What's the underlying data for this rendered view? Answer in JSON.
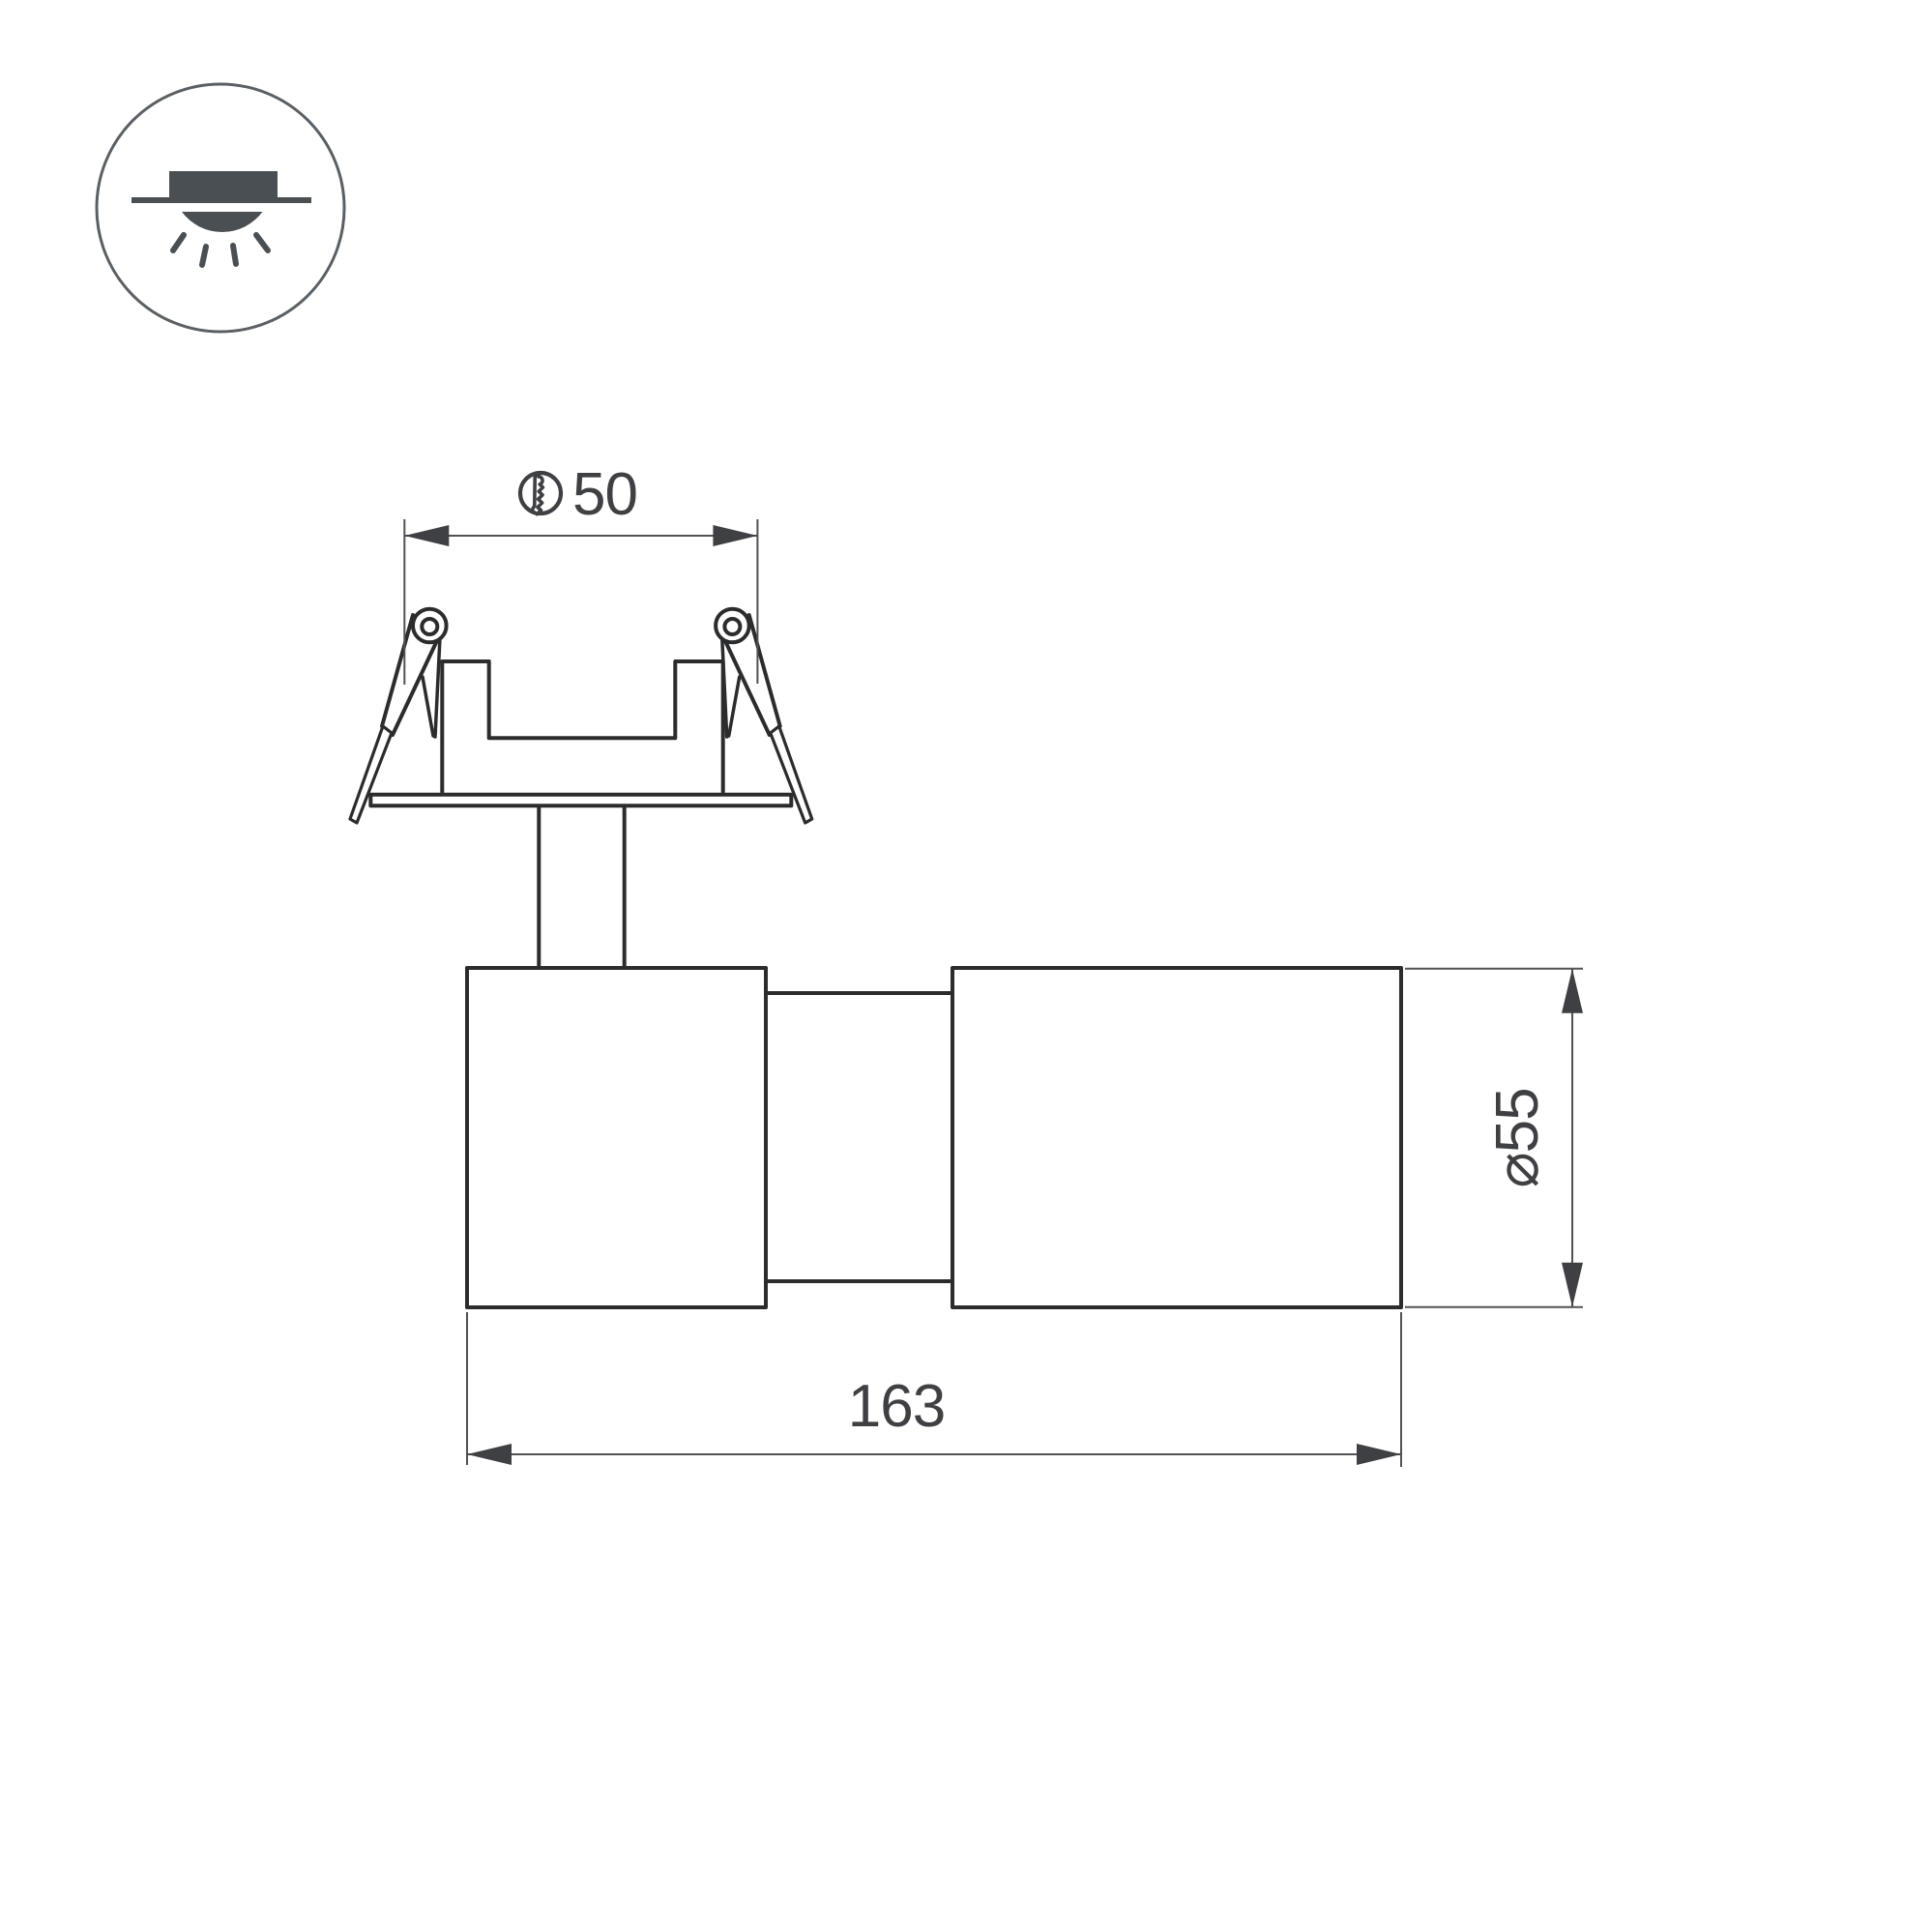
{
  "page": {
    "background": "#ffffff",
    "description_icons": {
      "installation_badge": "recessed-downlight-icon",
      "cutout_symbol": "cutout-hole-icon"
    }
  },
  "dimensions": {
    "cutout_width": {
      "value": "50",
      "symbol": "cutout-hole-icon"
    },
    "body_length": {
      "value": "163"
    },
    "body_diameter": {
      "value": "⌀55"
    }
  },
  "colors": {
    "page": "#ffffff",
    "outline": "#2b2c2e",
    "dimension": "#515254",
    "arrow": "#3e4043",
    "text": "#3e4043",
    "icon": "#4a4f54",
    "icon-ring": "#5a5f64"
  }
}
